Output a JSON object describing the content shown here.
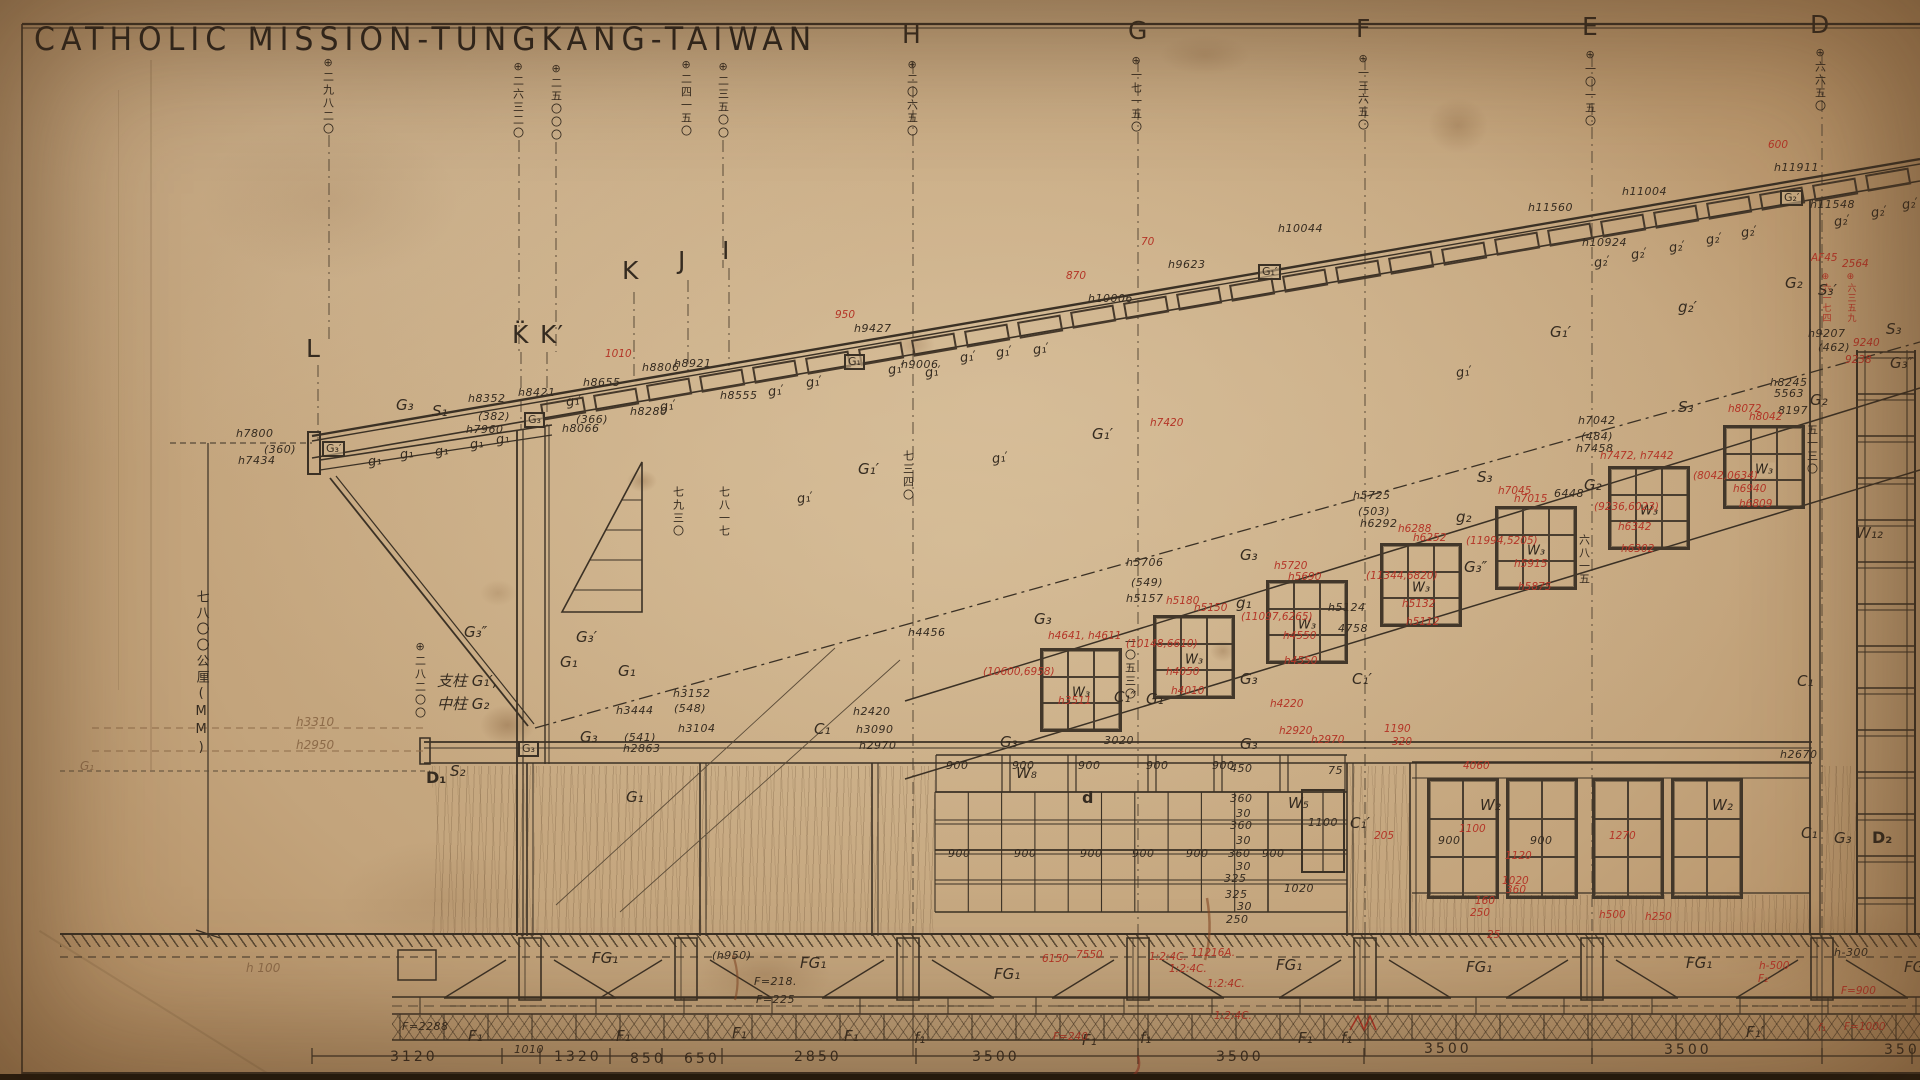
{
  "title": "CATHOLIC MISSION-TUNGKANG-TAIWAN",
  "colors": {
    "paper": "#c3a47c",
    "ink": "#352b20",
    "red": "#b43527",
    "faded": "#8d6b49"
  },
  "windows_slope": [
    {
      "x": 1040,
      "y": 648,
      "label": "W₃"
    },
    {
      "x": 1153,
      "y": 615,
      "label": "W₃"
    },
    {
      "x": 1266,
      "y": 580,
      "label": "W₃"
    },
    {
      "x": 1380,
      "y": 543,
      "label": "W₃"
    },
    {
      "x": 1495,
      "y": 506,
      "label": "W₃"
    },
    {
      "x": 1608,
      "y": 466,
      "label": "W₃"
    },
    {
      "x": 1723,
      "y": 425,
      "label": "W₃"
    }
  ],
  "windows_lower": [
    {
      "x": 1427,
      "y": 778,
      "label": ""
    },
    {
      "x": 1506,
      "y": 778,
      "label": ""
    },
    {
      "x": 1592,
      "y": 778,
      "label": ""
    },
    {
      "x": 1671,
      "y": 778,
      "label": ""
    }
  ],
  "annotations": [
    [
      306,
      336,
      "L",
      "L"
    ],
    [
      512,
      322,
      "L",
      "K̈"
    ],
    [
      540,
      322,
      "L",
      "K′"
    ],
    [
      622,
      258,
      "L",
      "K"
    ],
    [
      678,
      248,
      "L",
      "J"
    ],
    [
      722,
      238,
      "L",
      "I"
    ],
    [
      902,
      22,
      "L",
      "H"
    ],
    [
      1128,
      18,
      "L",
      "G"
    ],
    [
      1356,
      16,
      "L",
      "F"
    ],
    [
      1582,
      14,
      "L",
      "E"
    ],
    [
      1810,
      12,
      "L",
      "D"
    ],
    [
      322,
      56,
      "VB",
      "⊕二九八二〇"
    ],
    [
      512,
      60,
      "VB",
      "⊕二六三二〇"
    ],
    [
      550,
      62,
      "VB",
      "⊕二五〇〇〇"
    ],
    [
      680,
      58,
      "VB",
      "⊕二四一五〇"
    ],
    [
      717,
      60,
      "VB",
      "⊕二三五〇〇"
    ],
    [
      906,
      58,
      "VB",
      "⊕二〇六五〇"
    ],
    [
      1130,
      54,
      "VB",
      "⊕一七一五〇"
    ],
    [
      1357,
      52,
      "VB",
      "⊕一三六五〇"
    ],
    [
      1584,
      48,
      "VB",
      "⊕一〇一五〇"
    ],
    [
      1814,
      46,
      "VB",
      "⊕六六五〇"
    ],
    [
      414,
      640,
      "VB",
      "⊕二八二〇〇"
    ],
    [
      672,
      486,
      "VB",
      "七九三〇"
    ],
    [
      718,
      486,
      "VB",
      "七八一七"
    ],
    [
      902,
      450,
      "VB",
      "七三四〇"
    ],
    [
      1124,
      636,
      "VB",
      "一〇五三〇"
    ],
    [
      1578,
      534,
      "VB",
      "六八一五"
    ],
    [
      1806,
      424,
      "VB",
      "五一三〇"
    ],
    [
      194,
      590,
      "VL",
      "七八〇〇公厘(MM)"
    ],
    [
      1820,
      272,
      "VR",
      "⊕六一七四"
    ],
    [
      1845,
      272,
      "VR",
      "⊕六三五九"
    ],
    [
      296,
      716,
      "F",
      "h3310"
    ],
    [
      296,
      739,
      "F",
      "h2950"
    ],
    [
      246,
      962,
      "F",
      "h 100"
    ],
    [
      80,
      760,
      "F",
      "G₁"
    ],
    [
      236,
      428,
      "B",
      "h7800"
    ],
    [
      264,
      444,
      "B",
      "(360)"
    ],
    [
      238,
      455,
      "B",
      "h7434"
    ],
    [
      468,
      393,
      "B",
      "h8352"
    ],
    [
      478,
      411,
      "B",
      "(382)"
    ],
    [
      466,
      424,
      "B",
      "h7960"
    ],
    [
      518,
      387,
      "B",
      "h8421"
    ],
    [
      583,
      377,
      "B",
      "h8655"
    ],
    [
      642,
      362,
      "B",
      "h8806"
    ],
    [
      562,
      423,
      "B",
      "h8066"
    ],
    [
      576,
      414,
      "B",
      "(366)"
    ],
    [
      630,
      406,
      "B",
      "h8280"
    ],
    [
      674,
      358,
      "B",
      "h8921"
    ],
    [
      720,
      390,
      "B",
      "h8555"
    ],
    [
      854,
      323,
      "B",
      "h9427"
    ],
    [
      901,
      359,
      "B",
      "h9006"
    ],
    [
      1168,
      259,
      "B",
      "h9623"
    ],
    [
      1088,
      293,
      "B",
      "h10006"
    ],
    [
      1278,
      223,
      "B",
      "h10044"
    ],
    [
      1622,
      186,
      "B",
      "h11004"
    ],
    [
      1528,
      202,
      "B",
      "h11560"
    ],
    [
      1582,
      237,
      "B",
      "h10924"
    ],
    [
      1774,
      162,
      "B",
      "h11911"
    ],
    [
      1810,
      199,
      "B",
      "h11548"
    ],
    [
      1808,
      328,
      "B",
      "h9207"
    ],
    [
      1818,
      342,
      "B",
      "(462)"
    ],
    [
      1770,
      377,
      "B",
      "h8245"
    ],
    [
      1774,
      388,
      "B",
      "5563"
    ],
    [
      1778,
      405,
      "B",
      "8197"
    ],
    [
      1578,
      415,
      "B",
      "h7042"
    ],
    [
      1581,
      431,
      "B",
      "(484)"
    ],
    [
      1576,
      443,
      "B",
      "h7458"
    ],
    [
      1554,
      488,
      "B",
      "6448"
    ],
    [
      1353,
      490,
      "B",
      "h5725"
    ],
    [
      1358,
      506,
      "B",
      "(503)"
    ],
    [
      1360,
      518,
      "B",
      "h6292"
    ],
    [
      1126,
      557,
      "B",
      "h5706"
    ],
    [
      1131,
      577,
      "B",
      "(549)"
    ],
    [
      1126,
      593,
      "B",
      "h5157"
    ],
    [
      1328,
      602,
      "B",
      "h5124"
    ],
    [
      1338,
      623,
      "B",
      "4758"
    ],
    [
      908,
      627,
      "B",
      "h4456"
    ],
    [
      616,
      705,
      "B",
      "h3444"
    ],
    [
      624,
      732,
      "B",
      "(541)"
    ],
    [
      623,
      743,
      "B",
      "h2863"
    ],
    [
      673,
      688,
      "B",
      "h3152"
    ],
    [
      674,
      703,
      "B",
      "(548)"
    ],
    [
      678,
      723,
      "B",
      "h3104"
    ],
    [
      853,
      706,
      "B",
      "h2420"
    ],
    [
      856,
      724,
      "B",
      "h3090"
    ],
    [
      859,
      740,
      "B",
      "h2970"
    ],
    [
      1780,
      749,
      "B",
      "h2670"
    ],
    [
      1104,
      735,
      "B",
      "3020"
    ],
    [
      1230,
      763,
      "B",
      "450"
    ],
    [
      1328,
      765,
      "B",
      "75"
    ],
    [
      1308,
      817,
      "B",
      "1100"
    ],
    [
      1284,
      883,
      "B",
      "1020"
    ],
    [
      1226,
      914,
      "B",
      "250"
    ],
    [
      1438,
      835,
      "B",
      "900"
    ],
    [
      1530,
      835,
      "B",
      "900"
    ],
    [
      1834,
      947,
      "B",
      "h-300"
    ],
    [
      712,
      950,
      "B",
      "(h950)"
    ],
    [
      754,
      976,
      "B",
      "F=218."
    ],
    [
      756,
      994,
      "B",
      "F=225"
    ],
    [
      402,
      1021,
      "B",
      "F=2288"
    ],
    [
      514,
      1044,
      "B",
      "1010"
    ],
    [
      946,
      760,
      "B",
      "900"
    ],
    [
      1012,
      760,
      "B",
      "900"
    ],
    [
      1078,
      760,
      "B",
      "900"
    ],
    [
      1146,
      760,
      "B",
      "900"
    ],
    [
      1212,
      760,
      "B",
      "900"
    ],
    [
      948,
      848,
      "B",
      "900"
    ],
    [
      1014,
      848,
      "B",
      "900"
    ],
    [
      1080,
      848,
      "B",
      "900"
    ],
    [
      1132,
      848,
      "B",
      "900"
    ],
    [
      1186,
      848,
      "B",
      "900"
    ],
    [
      1228,
      848,
      "B",
      "360"
    ],
    [
      1262,
      848,
      "B",
      "900"
    ],
    [
      1230,
      793,
      "B",
      "360"
    ],
    [
      1230,
      820,
      "B",
      "360"
    ],
    [
      1224,
      873,
      "B",
      "325"
    ],
    [
      1225,
      889,
      "B",
      "325"
    ],
    [
      1236,
      808,
      "B",
      "30"
    ],
    [
      1236,
      835,
      "B",
      "30"
    ],
    [
      1236,
      861,
      "B",
      "30"
    ],
    [
      1237,
      901,
      "B",
      "30"
    ],
    [
      396,
      398,
      "M",
      "G₃"
    ],
    [
      432,
      404,
      "M",
      "S₁"
    ],
    [
      576,
      630,
      "M",
      "G₃′"
    ],
    [
      464,
      625,
      "M",
      "G₃″"
    ],
    [
      580,
      730,
      "M",
      "G₃"
    ],
    [
      814,
      722,
      "M",
      "C₁"
    ],
    [
      858,
      462,
      "M",
      "G₁′"
    ],
    [
      1092,
      427,
      "M",
      "G₁′"
    ],
    [
      1550,
      325,
      "M",
      "G₁′"
    ],
    [
      1678,
      300,
      "M",
      "g₂′"
    ],
    [
      1785,
      276,
      "M",
      "G₂"
    ],
    [
      1810,
      393,
      "M",
      "G₂"
    ],
    [
      1584,
      478,
      "M",
      "G₂"
    ],
    [
      1236,
      596,
      "M",
      "g₁"
    ],
    [
      1456,
      510,
      "M",
      "g₂"
    ],
    [
      1678,
      400,
      "M",
      "S₃"
    ],
    [
      1477,
      470,
      "M",
      "S₃"
    ],
    [
      1886,
      322,
      "M",
      "S₃"
    ],
    [
      1818,
      283,
      "M",
      "S₃′"
    ],
    [
      1034,
      612,
      "M",
      "G₃"
    ],
    [
      1240,
      548,
      "M",
      "G₃"
    ],
    [
      1240,
      672,
      "M",
      "G₃"
    ],
    [
      1464,
      560,
      "M",
      "G₃″"
    ],
    [
      1000,
      735,
      "M",
      "G₃"
    ],
    [
      1240,
      737,
      "M",
      "G₃"
    ],
    [
      1352,
      672,
      "M",
      "C₁′"
    ],
    [
      1114,
      690,
      "M",
      "C₁″"
    ],
    [
      1146,
      692,
      "M",
      "G₁"
    ],
    [
      1350,
      816,
      "M",
      "C₁′"
    ],
    [
      560,
      655,
      "M",
      "G₁"
    ],
    [
      618,
      664,
      "M",
      "G₁"
    ],
    [
      626,
      790,
      "M",
      "G₁"
    ],
    [
      1856,
      526,
      "M",
      "W₁₂"
    ],
    [
      1890,
      356,
      "M",
      "G₃″"
    ],
    [
      1797,
      674,
      "M",
      "C₁"
    ],
    [
      1801,
      826,
      "M",
      "C₁"
    ],
    [
      1834,
      831,
      "M",
      "G₃"
    ],
    [
      1480,
      798,
      "M",
      "W₂"
    ],
    [
      1712,
      798,
      "M",
      "W₂"
    ],
    [
      1288,
      796,
      "M",
      "W₅"
    ],
    [
      1016,
      766,
      "M",
      "W₈"
    ],
    [
      450,
      764,
      "M",
      "S₂"
    ],
    [
      437,
      697,
      "M",
      "中柱 G₂"
    ],
    [
      437,
      674,
      "M",
      "支柱 G₁′,"
    ],
    [
      426,
      770,
      "BD",
      "D₁"
    ],
    [
      1872,
      830,
      "BD",
      "D₂"
    ],
    [
      1082,
      790,
      "BD",
      "d"
    ],
    [
      592,
      951,
      "M",
      "FG₁"
    ],
    [
      800,
      956,
      "M",
      "FG₁"
    ],
    [
      994,
      967,
      "M",
      "FG₁"
    ],
    [
      1276,
      958,
      "M",
      "FG₁"
    ],
    [
      1466,
      960,
      "M",
      "FG₁"
    ],
    [
      1686,
      956,
      "M",
      "FG₁"
    ],
    [
      1904,
      960,
      "M",
      "FG₁"
    ],
    [
      468,
      1029,
      "M",
      "F₁"
    ],
    [
      616,
      1029,
      "M",
      "F₁"
    ],
    [
      732,
      1026,
      "M",
      "F₁"
    ],
    [
      844,
      1029,
      "M",
      "F₁"
    ],
    [
      1082,
      1033,
      "M",
      "F₁"
    ],
    [
      1298,
      1031,
      "M",
      "F₁"
    ],
    [
      1746,
      1025,
      "M",
      "F₁′"
    ],
    [
      914,
      1031,
      "M",
      "f₁"
    ],
    [
      1140,
      1031,
      "M",
      "f₁"
    ],
    [
      1341,
      1031,
      "M",
      "f₁"
    ],
    [
      368,
      455,
      "S",
      "g₁"
    ],
    [
      400,
      448,
      "S",
      "g₁"
    ],
    [
      435,
      445,
      "S",
      "g₁"
    ],
    [
      470,
      438,
      "S",
      "g₁"
    ],
    [
      496,
      433,
      "S",
      "g₁"
    ],
    [
      566,
      395,
      "S",
      "g₁′"
    ],
    [
      660,
      400,
      "S",
      "g₁′"
    ],
    [
      768,
      385,
      "S",
      "g₁′"
    ],
    [
      806,
      376,
      "S",
      "g₁′"
    ],
    [
      888,
      363,
      "S",
      "g₁′"
    ],
    [
      925,
      366,
      "S",
      "g₁′"
    ],
    [
      960,
      351,
      "S",
      "g₁′"
    ],
    [
      996,
      346,
      "S",
      "g₁′"
    ],
    [
      1033,
      343,
      "S",
      "g₁′"
    ],
    [
      797,
      492,
      "S",
      "g₁′"
    ],
    [
      992,
      452,
      "S",
      "g₁′"
    ],
    [
      1456,
      366,
      "S",
      "g₁′"
    ],
    [
      1594,
      256,
      "S",
      "g₂′"
    ],
    [
      1631,
      248,
      "S",
      "g₂′"
    ],
    [
      1669,
      241,
      "S",
      "g₂′"
    ],
    [
      1706,
      233,
      "S",
      "g₂′"
    ],
    [
      1741,
      226,
      "S",
      "g₂′"
    ],
    [
      1834,
      215,
      "S",
      "g₂′"
    ],
    [
      1871,
      206,
      "S",
      "g₂′"
    ],
    [
      1902,
      198,
      "S",
      "g₂′"
    ],
    [
      390,
      1050,
      "D",
      "3120"
    ],
    [
      554,
      1050,
      "D",
      "1320"
    ],
    [
      630,
      1052,
      "D",
      "850"
    ],
    [
      684,
      1052,
      "D",
      "650"
    ],
    [
      794,
      1050,
      "D",
      "2850"
    ],
    [
      972,
      1050,
      "D",
      "3500"
    ],
    [
      1216,
      1050,
      "D",
      "3500"
    ],
    [
      1424,
      1042,
      "D",
      "3500"
    ],
    [
      1664,
      1043,
      "D",
      "3500"
    ],
    [
      1884,
      1043,
      "D",
      "350"
    ],
    [
      605,
      349,
      "R",
      "1010"
    ],
    [
      835,
      310,
      "R",
      "950"
    ],
    [
      1066,
      271,
      "R",
      "870"
    ],
    [
      1141,
      237,
      "R",
      "70"
    ],
    [
      1768,
      140,
      "R",
      "600"
    ],
    [
      1048,
      631,
      "R",
      "h4641, h4611"
    ],
    [
      983,
      667,
      "R",
      "(10600,6958)"
    ],
    [
      1058,
      696,
      "R",
      "h3511"
    ],
    [
      1166,
      596,
      "R",
      "h5180"
    ],
    [
      1194,
      603,
      "R",
      "h5150"
    ],
    [
      1126,
      639,
      "R",
      "(10148,6610)"
    ],
    [
      1166,
      667,
      "R",
      "h4050"
    ],
    [
      1171,
      686,
      "R",
      "h4010"
    ],
    [
      1274,
      561,
      "R",
      "h5720"
    ],
    [
      1288,
      572,
      "R",
      "h5690"
    ],
    [
      1241,
      612,
      "R",
      "(11097,6265)"
    ],
    [
      1283,
      631,
      "R",
      "h4550"
    ],
    [
      1284,
      656,
      "R",
      "h4550"
    ],
    [
      1398,
      524,
      "R",
      "h6288"
    ],
    [
      1413,
      533,
      "R",
      "h6252"
    ],
    [
      1366,
      571,
      "R",
      "(11344,6820)"
    ],
    [
      1402,
      599,
      "R",
      "h5132"
    ],
    [
      1406,
      617,
      "R",
      "h5112"
    ],
    [
      1498,
      486,
      "R",
      "h7045"
    ],
    [
      1514,
      494,
      "R",
      "h7015"
    ],
    [
      1466,
      536,
      "R",
      "(11994,5205)"
    ],
    [
      1514,
      559,
      "R",
      "h5915"
    ],
    [
      1518,
      582,
      "R",
      "h5875"
    ],
    [
      1600,
      451,
      "R",
      "h7472, h7442"
    ],
    [
      1594,
      502,
      "R",
      "(9236,6023)"
    ],
    [
      1618,
      522,
      "R",
      "h6342"
    ],
    [
      1621,
      544,
      "R",
      "h6302"
    ],
    [
      1728,
      404,
      "R",
      "h8072"
    ],
    [
      1749,
      412,
      "R",
      "h8042"
    ],
    [
      1693,
      471,
      "R",
      "(8042,0634)"
    ],
    [
      1733,
      484,
      "R",
      "h6940"
    ],
    [
      1739,
      499,
      "R",
      "h6809"
    ],
    [
      1853,
      338,
      "R",
      "9240"
    ],
    [
      1845,
      355,
      "R",
      "9238"
    ],
    [
      1811,
      253,
      "R",
      "AF45"
    ],
    [
      1842,
      259,
      "R",
      "2564"
    ],
    [
      1150,
      418,
      "R",
      "h7420"
    ],
    [
      1279,
      726,
      "R",
      "h2920"
    ],
    [
      1311,
      735,
      "R",
      "h2970"
    ],
    [
      1384,
      724,
      "R",
      "1190"
    ],
    [
      1392,
      737,
      "R",
      "320"
    ],
    [
      1463,
      761,
      "R",
      "4060"
    ],
    [
      1270,
      699,
      "R",
      "h4220"
    ],
    [
      1459,
      824,
      "R",
      "1100"
    ],
    [
      1609,
      831,
      "R",
      "1270"
    ],
    [
      1505,
      851,
      "R",
      "1120"
    ],
    [
      1374,
      831,
      "R",
      "205"
    ],
    [
      1599,
      910,
      "R",
      "h500"
    ],
    [
      1645,
      912,
      "R",
      "h250"
    ],
    [
      1502,
      876,
      "R",
      "1020"
    ],
    [
      1506,
      885,
      "R",
      "360"
    ],
    [
      1475,
      896,
      "R",
      "160"
    ],
    [
      1470,
      908,
      "R",
      "250"
    ],
    [
      1487,
      930,
      "R",
      "25"
    ],
    [
      1042,
      954,
      "R",
      "6150"
    ],
    [
      1076,
      950,
      "R",
      "7550"
    ],
    [
      1149,
      952,
      "R",
      "1:2:4C."
    ],
    [
      1191,
      948,
      "R",
      "11216A."
    ],
    [
      1169,
      964,
      "R",
      "1:2:4C."
    ],
    [
      1207,
      979,
      "R",
      "1:2:4C."
    ],
    [
      1214,
      1011,
      "R",
      "1:2:4C."
    ],
    [
      1053,
      1032,
      "R",
      "F=240"
    ],
    [
      1759,
      961,
      "R",
      "h-500"
    ],
    [
      1758,
      974,
      "R",
      "F₂"
    ],
    [
      1841,
      986,
      "R",
      "F=900"
    ],
    [
      1844,
      1022,
      "R",
      "F=1000"
    ],
    [
      1818,
      1023,
      "R",
      "f₁"
    ],
    [
      322,
      441,
      "BO",
      "G₃′"
    ],
    [
      524,
      412,
      "BO",
      "G₃"
    ],
    [
      844,
      354,
      "BO",
      "G₁"
    ],
    [
      1258,
      264,
      "BO",
      "G₁′"
    ],
    [
      1780,
      190,
      "BO",
      "G₂′"
    ],
    [
      518,
      741,
      "BO",
      "G₃"
    ]
  ]
}
